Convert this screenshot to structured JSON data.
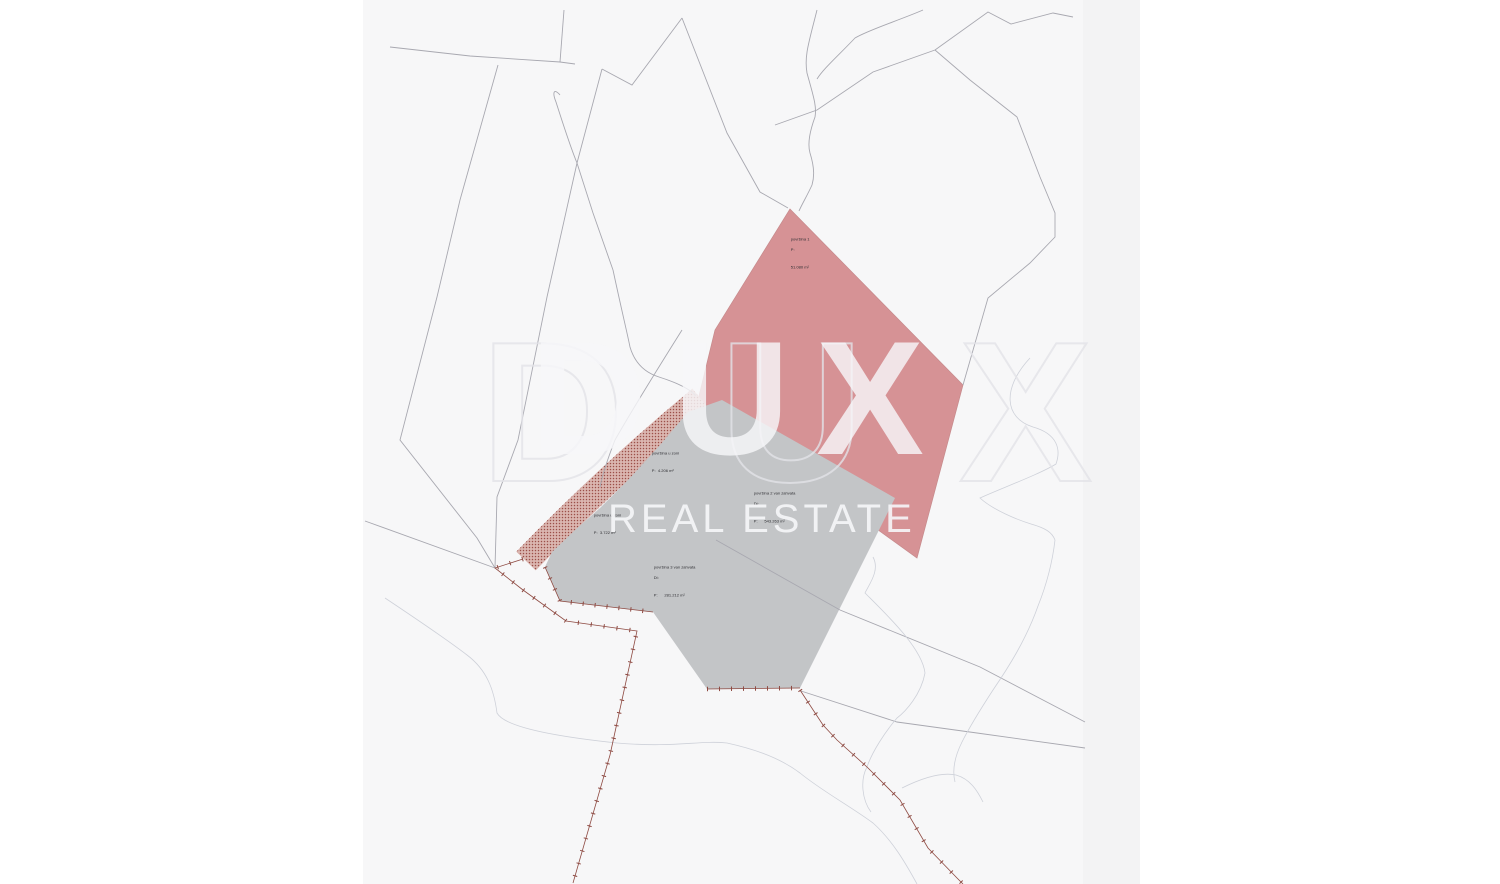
{
  "watermark": {
    "logo": "DUX",
    "subtitle": "REAL ESTATE"
  },
  "labels": [
    {
      "name": "parcel-1-pink",
      "lines": [
        "površina 1",
        "P:",
        "51.080 m²"
      ]
    },
    {
      "name": "parcel-2-gray",
      "lines": [
        "površina 2 van zahvata",
        "Di:",
        "P:      543.263 m²"
      ]
    },
    {
      "name": "parcel-3-gray",
      "lines": [
        "površina 3 van zahvata",
        "Di:",
        "P:      281.212 m²"
      ]
    },
    {
      "name": "zone-strip-upper",
      "lines": [
        "površina u zoni",
        "P:  4.206 m²"
      ]
    },
    {
      "name": "zone-strip-lower",
      "lines": [
        "površina u zoni",
        "P:  3.722 m²"
      ]
    }
  ],
  "colors": {
    "page": "#ffffff",
    "sheet": "#f7f7f8",
    "sheet_edge_strip": "#f3f3f4",
    "parcel_pink": "#d69295",
    "parcel_pink_edge": "#c68a8c",
    "parcel_gray": "#c3c5c7",
    "hatch_bg": "#dbb6b0",
    "hatch_dot": "#9c4f48",
    "boundary_line": "#a8a8b0",
    "contour_line": "#ced1d9",
    "cadastral_line": "#8e4a42",
    "label_text": "#2f2f33"
  }
}
